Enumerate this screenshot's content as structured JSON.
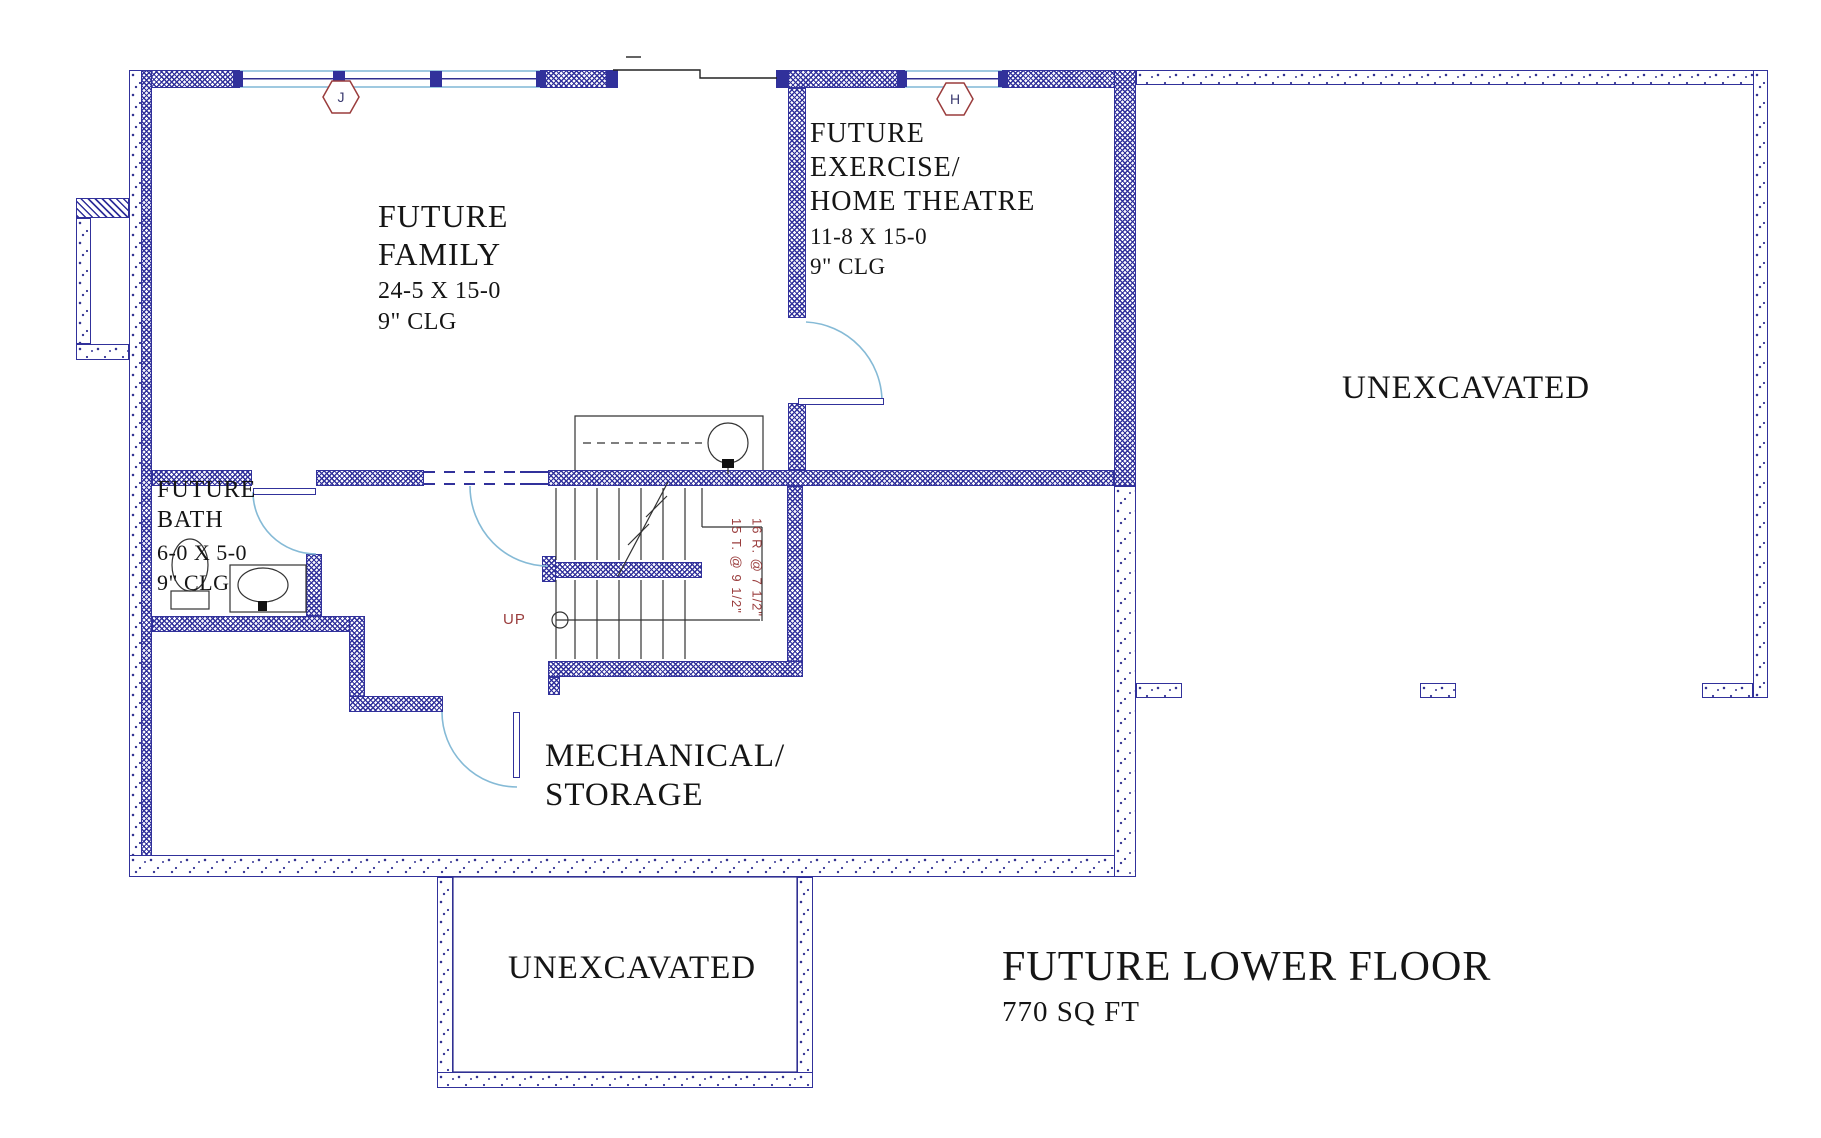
{
  "title": {
    "main": "FUTURE LOWER FLOOR",
    "area": "770 SQ FT"
  },
  "rooms": {
    "family": {
      "lines": [
        "FUTURE",
        "FAMILY",
        "24-5 X 15-0",
        "9\" CLG"
      ]
    },
    "exercise": {
      "lines": [
        "FUTURE",
        "EXERCISE/",
        "HOME THEATRE",
        "11-8 X 15-0",
        "9\" CLG"
      ]
    },
    "bath": {
      "lines": [
        "FUTURE",
        "BATH",
        "6-0 X 5-0",
        "9\" CLG"
      ]
    },
    "mechanical": {
      "lines": [
        "MECHANICAL/",
        "STORAGE"
      ]
    },
    "unexcavated_right": {
      "label": "UNEXCAVATED"
    },
    "unexcavated_bottom": {
      "label": "UNEXCAVATED"
    }
  },
  "stairs": {
    "up_label": "UP",
    "risers_note": "16 R. @ 7 1/2\"",
    "treads_note": "15 T. @ 9 1/2\""
  },
  "markers": [
    {
      "label": "J"
    },
    {
      "label": "H"
    }
  ],
  "colors": {
    "wall_navy": "#31319b",
    "speckle": "#2d2d8f",
    "window_blue": "#9fc9e0",
    "door_arc_blue": "#85bad6",
    "annotation_red": "#9a3c3c",
    "text": "#151515"
  }
}
